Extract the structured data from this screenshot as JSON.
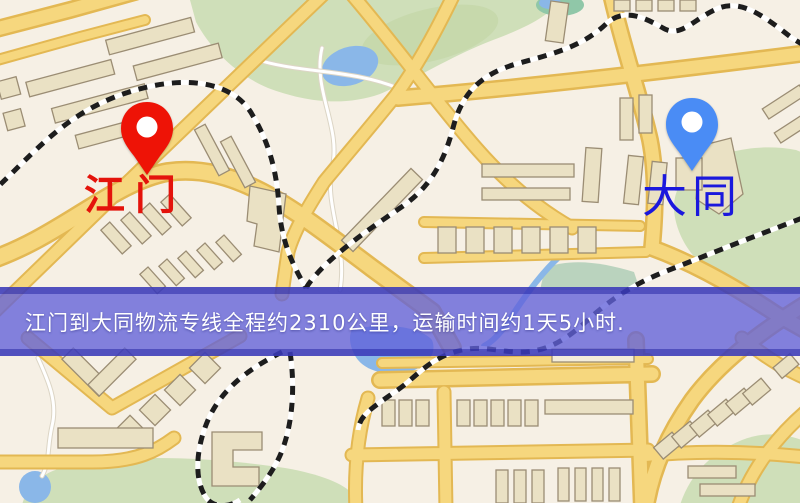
{
  "banner": {
    "text": "江门到大同物流专线全程约2310公里，运输时间约1天5小时.",
    "background_color": "#6161da",
    "text_color": "#ffffff"
  },
  "markers": {
    "origin": {
      "label": "江门",
      "label_color": "#e4130b",
      "pin_color": "#ee1306",
      "pin_icon": "map-pin"
    },
    "destination": {
      "label": "大同",
      "label_color": "#1b18dd",
      "pin_color": "#4a8cf5",
      "pin_icon": "map-pin"
    }
  },
  "map_palette": {
    "background": "#f6f0e5",
    "road_fill": "#f6d77e",
    "road_casing": "#e3b853",
    "park": "#cfdfb9",
    "water": "#8ab7e8",
    "building": "#eae1c4",
    "railway": "#1d1d1d"
  }
}
